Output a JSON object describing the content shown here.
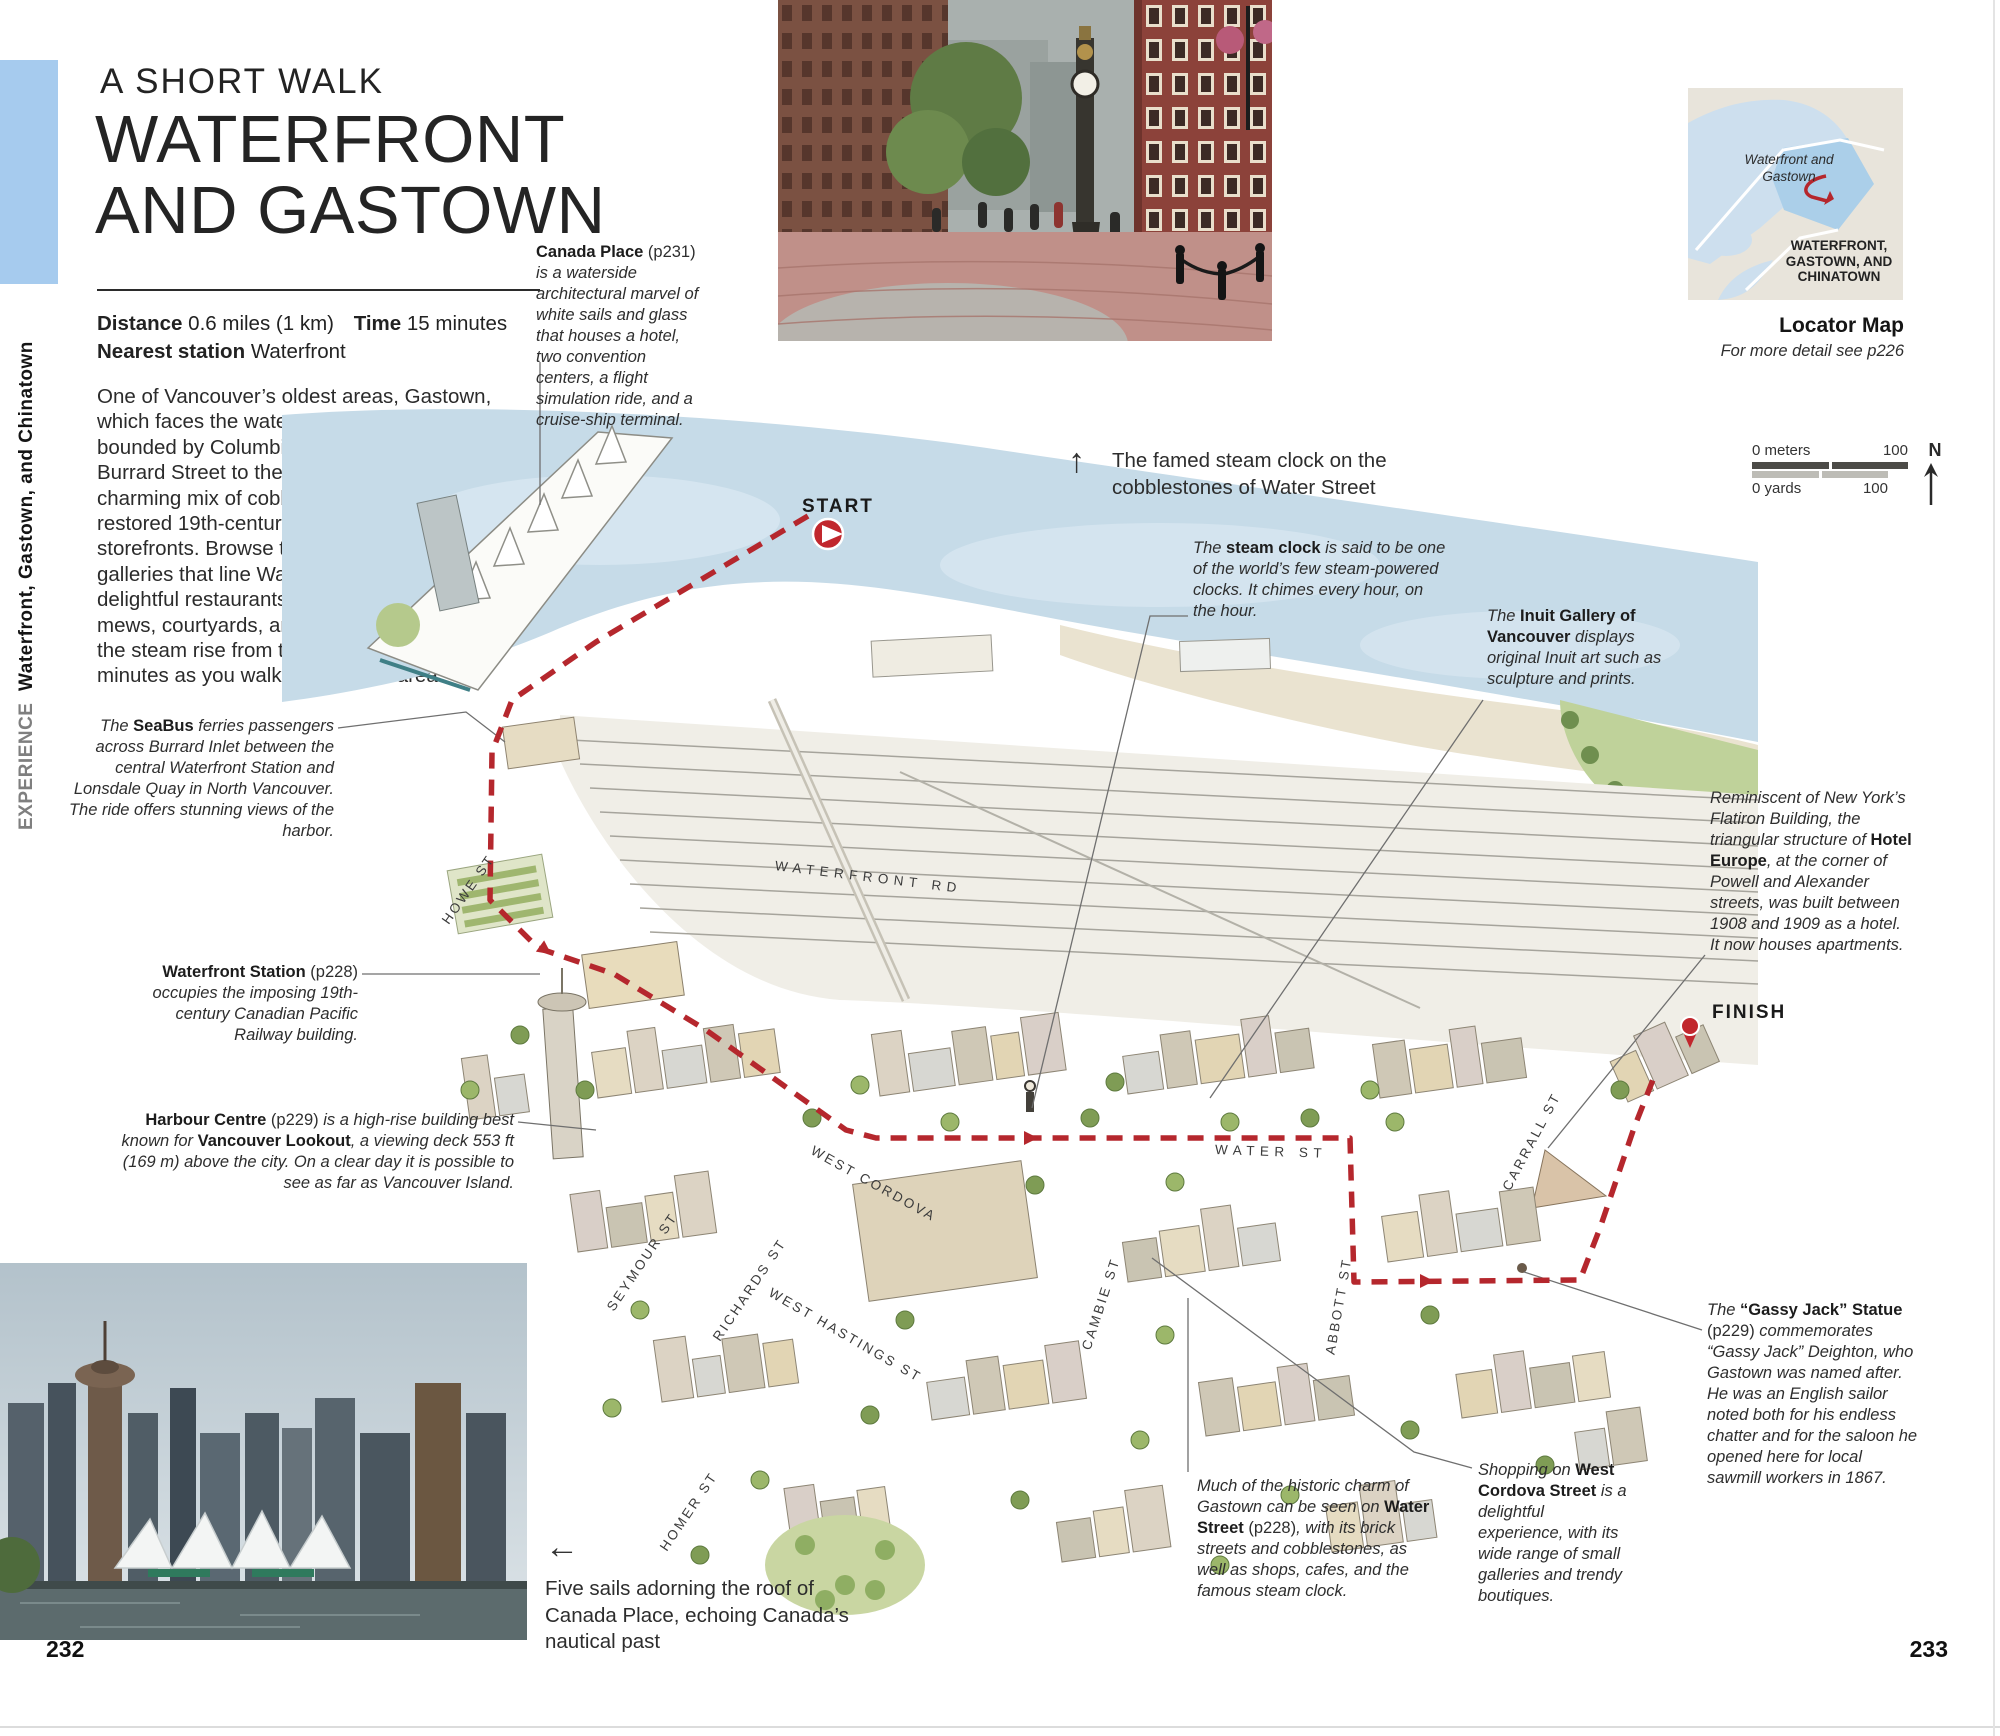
{
  "page": {
    "left_number": "232",
    "right_number": "233"
  },
  "sidebar": {
    "experience": "EXPERIENCE",
    "section": "Waterfront, Gastown, and Chinatown"
  },
  "header": {
    "kicker": "A SHORT WALK",
    "title_line1": "WATERFRONT",
    "title_line2": "AND GASTOWN"
  },
  "info": {
    "distance_label": "Distance",
    "distance_value": "0.6 miles (1 km)",
    "time_label": "Time",
    "time_value": "15 minutes",
    "station_label": "Nearest station",
    "station_value": "Waterfront"
  },
  "intro": "One of Vancouver’s oldest areas, Gastown, which faces the waters of Burrard Inlet, is bounded by Columbia Street to the east and Burrard Street to the west. Gastown is a charming mix of cobblestone streets and restored 19th-century public buildings and storefronts. Browse the chic boutiques and galleries that line Water Street, dip into the delightful restaurants and cafes that fill the mews, courtyards, and passages, and watch the steam rise from the steam clock every 15 minutes as you walk through the area.",
  "photos": {
    "up_arrow": "↑",
    "left_arrow": "←",
    "steam_clock_caption": "The famed steam clock on the cobblestones of Water Street",
    "canada_place_caption": "Five sails adorning the roof of Canada Place, echoing Canada’s nautical past"
  },
  "locator": {
    "area_label": "Waterfront and Gastown",
    "district_label": "WATERFRONT, GASTOWN, AND CHINATOWN",
    "title": "Locator Map",
    "subtitle": "For more detail see p226"
  },
  "scale": {
    "meters_left": "0 meters",
    "meters_right": "100",
    "yards_left": "0 yards",
    "yards_right": "100",
    "north": "N"
  },
  "route": {
    "start_label": "START",
    "finish_label": "FINISH",
    "color": "#b5272d"
  },
  "map": {
    "street_labels": [
      {
        "text": "HOWE ST"
      },
      {
        "text": "WATERFRONT RD"
      },
      {
        "text": "SEYMOUR ST"
      },
      {
        "text": "RICHARDS ST"
      },
      {
        "text": "HOMER ST"
      },
      {
        "text": "WEST CORDOVA"
      },
      {
        "text": "WEST HASTINGS ST"
      },
      {
        "text": "CAMBIE ST"
      },
      {
        "text": "WATER ST"
      },
      {
        "text": "ABBOTT ST"
      },
      {
        "text": "CARRALL ST"
      }
    ]
  },
  "annotations": [
    {
      "name": "canada-place",
      "segments": [
        {
          "s": "b",
          "t": "Canada Place"
        },
        {
          "s": "r",
          "t": " (p231) "
        },
        {
          "s": "i",
          "t": "is a waterside architectural marvel of white sails and glass that houses a hotel, two convention centers, a flight simulation ride, and a cruise-ship terminal."
        }
      ]
    },
    {
      "name": "seabus",
      "segments": [
        {
          "s": "i",
          "t": "The "
        },
        {
          "s": "b",
          "t": "SeaBus"
        },
        {
          "s": "i",
          "t": " ferries passengers across Burrard Inlet between the central Waterfront Station and Lonsdale Quay in North Vancouver. The ride offers stunning views of the harbor."
        }
      ]
    },
    {
      "name": "waterfront-station",
      "segments": [
        {
          "s": "b",
          "t": "Waterfront Station"
        },
        {
          "s": "r",
          "t": " (p228) "
        },
        {
          "s": "i",
          "t": "occupies the imposing 19th-century Canadian Pacific Railway building."
        }
      ]
    },
    {
      "name": "harbour-centre",
      "segments": [
        {
          "s": "b",
          "t": "Harbour Centre"
        },
        {
          "s": "r",
          "t": " (p229) "
        },
        {
          "s": "i",
          "t": "is a high-rise building best known for "
        },
        {
          "s": "b",
          "t": "Vancouver Lookout"
        },
        {
          "s": "i",
          "t": ", a viewing deck 553 ft (169 m) above the city. On a clear day it is possible to see as far as Vancouver Island."
        }
      ]
    },
    {
      "name": "steam-clock",
      "segments": [
        {
          "s": "i",
          "t": "The "
        },
        {
          "s": "b",
          "t": "steam clock"
        },
        {
          "s": "i",
          "t": " is said to be one of the world’s few steam-powered clocks. It chimes every hour, on the hour."
        }
      ]
    },
    {
      "name": "inuit-gallery",
      "segments": [
        {
          "s": "i",
          "t": "The "
        },
        {
          "s": "b",
          "t": "Inuit Gallery of Vancouver"
        },
        {
          "s": "i",
          "t": " displays original Inuit art such as sculpture and prints."
        }
      ]
    },
    {
      "name": "hotel-europe",
      "segments": [
        {
          "s": "i",
          "t": "Reminiscent of New York’s Flatiron Building, the triangular structure of "
        },
        {
          "s": "b",
          "t": "Hotel Europe"
        },
        {
          "s": "i",
          "t": ", at the corner of Powell and Alexander streets, was built between 1908 and 1909 as a hotel. It now houses apartments."
        }
      ]
    },
    {
      "name": "gassy-jack",
      "segments": [
        {
          "s": "i",
          "t": "The "
        },
        {
          "s": "b",
          "t": "“Gassy Jack” Statue"
        },
        {
          "s": "r",
          "t": " (p229) "
        },
        {
          "s": "i",
          "t": "commemorates “Gassy Jack” Deighton, who Gastown was named after. He was an English sailor noted both for his endless chatter and for the saloon he opened here for local sawmill workers in 1867."
        }
      ]
    },
    {
      "name": "water-street",
      "segments": [
        {
          "s": "i",
          "t": "Much of the historic charm of Gastown can be seen on "
        },
        {
          "s": "b",
          "t": "Water Street"
        },
        {
          "s": "r",
          "t": " (p228)"
        },
        {
          "s": "i",
          "t": ", with its brick streets and cobblestones, as well as shops, cafes, and the famous steam clock."
        }
      ]
    },
    {
      "name": "west-cordova",
      "segments": [
        {
          "s": "i",
          "t": "Shopping on "
        },
        {
          "s": "b",
          "t": "West Cordova Street"
        },
        {
          "s": "i",
          "t": " is a delightful experience, with its wide range of small galleries and trendy boutiques."
        }
      ]
    }
  ]
}
